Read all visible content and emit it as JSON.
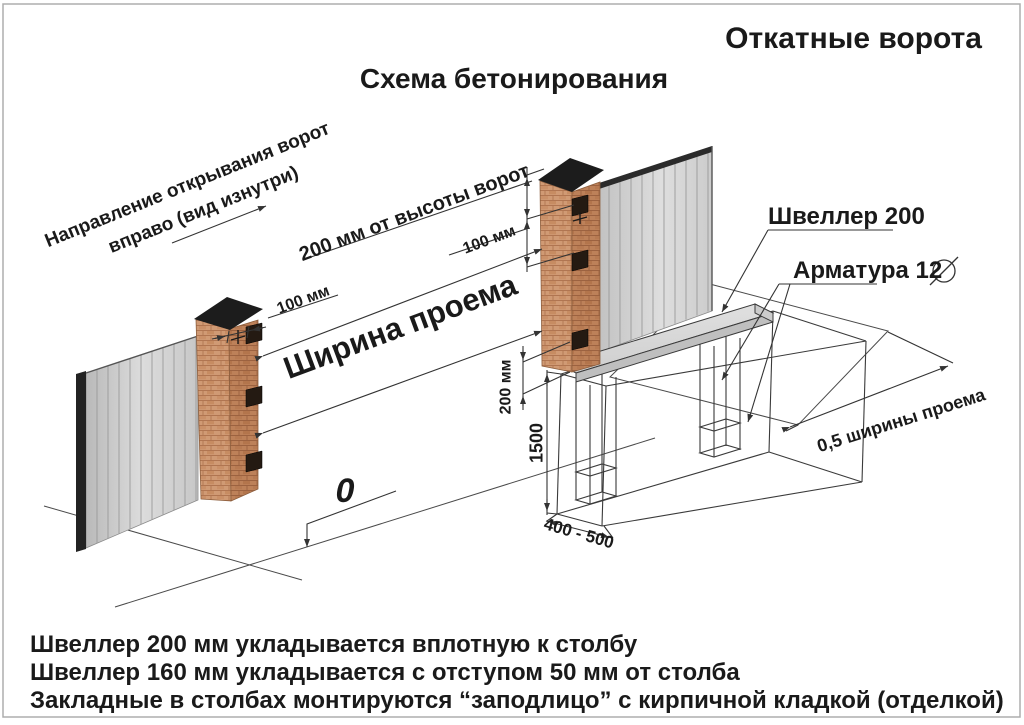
{
  "titles": {
    "main": "Откатные ворота",
    "subtitle": "Схема бетонирования"
  },
  "annotations": {
    "direction_note_line1": "Направление открывания ворот",
    "direction_note_line2": "вправо (вид изнутри)",
    "gate_height_offset": "200 мм от высоты ворот",
    "plate_offset_right": "100 мм",
    "plate_offset_left": "100 мм",
    "opening_width": "Ширина проема",
    "channel_label": "Швеллер 200",
    "rebar_label": "Арматура 12",
    "half_opening_width": "0,5 ширины проема",
    "trench_depth": "1500",
    "trench_width": "400 - 500",
    "channel_level_offset": "200 мм",
    "zero_mark": "0"
  },
  "footnotes": {
    "line1": "Швеллер 200 мм укладывается вплотную к столбу",
    "line2": "Швеллер 160 мм укладывается с отступом 50 мм от столба",
    "line3": "Закладные в столбах монтируются “заподлицо” с кирпичной кладкой (отделкой)"
  },
  "colors": {
    "background": "#ffffff",
    "line": "#3a3a3a",
    "brick_light": "#d09a74",
    "brick_dark": "#bd8159",
    "mortar": "#a96f4c",
    "pillar_cap": "#1c1c1c",
    "fence_panel": "#d6d6d6",
    "channel_steel": "#d9d9d9",
    "text": "#1a1a1a"
  }
}
